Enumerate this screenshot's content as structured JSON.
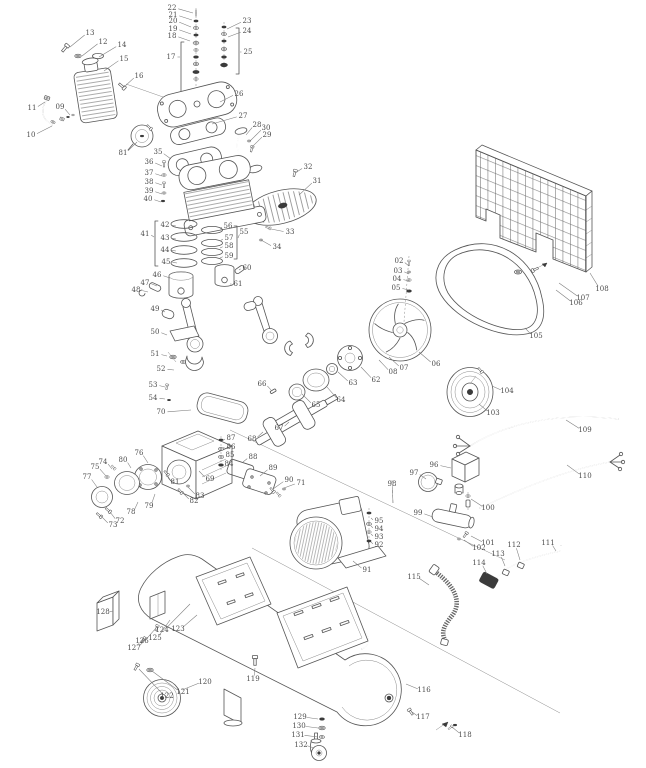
{
  "meta": {
    "description": "Exploded parts diagram of a belt-drive air compressor",
    "background": "#ffffff",
    "line_color": "#555555",
    "label_color": "#4c4c4c"
  },
  "labels": [
    {
      "n": "02",
      "x": 399,
      "y": 261,
      "lx": 409,
      "ly": 266
    },
    {
      "n": "03",
      "x": 398,
      "y": 271,
      "lx": 409,
      "ly": 274
    },
    {
      "n": "04",
      "x": 397,
      "y": 279,
      "lx": 409,
      "ly": 281
    },
    {
      "n": "05",
      "x": 396,
      "y": 288,
      "lx": 409,
      "ly": 290
    },
    {
      "n": "06",
      "x": 436,
      "y": 364,
      "lx": 419,
      "ly": 352
    },
    {
      "n": "07",
      "x": 404,
      "y": 368,
      "lx": 389,
      "ly": 357
    },
    {
      "n": "08",
      "x": 393,
      "y": 372,
      "lx": 379,
      "ly": 360
    },
    {
      "n": "09",
      "x": 60,
      "y": 107,
      "lx": 70,
      "ly": 115
    },
    {
      "n": "10",
      "x": 31,
      "y": 135,
      "lx": 52,
      "ly": 126
    },
    {
      "n": "11",
      "x": 32,
      "y": 108,
      "lx": 45,
      "ly": 102
    },
    {
      "n": "12",
      "x": 103,
      "y": 42,
      "lx": 82,
      "ly": 56
    },
    {
      "n": "13",
      "x": 90,
      "y": 33,
      "lx": 70,
      "ly": 47
    },
    {
      "n": "14",
      "x": 122,
      "y": 45,
      "lx": 99,
      "ly": 57
    },
    {
      "n": "15",
      "x": 124,
      "y": 59,
      "lx": 104,
      "ly": 71
    },
    {
      "n": "16",
      "x": 139,
      "y": 76,
      "lx": 124,
      "ly": 87
    },
    {
      "n": "17",
      "x": 171,
      "y": 57,
      "lx": 180,
      "ly": 57
    },
    {
      "n": "18",
      "x": 172,
      "y": 36,
      "lx": 190,
      "ly": 41
    },
    {
      "n": "19",
      "x": 173,
      "y": 29,
      "lx": 191,
      "ly": 34
    },
    {
      "n": "20",
      "x": 173,
      "y": 21,
      "lx": 191,
      "ly": 27
    },
    {
      "n": "21",
      "x": 173,
      "y": 15,
      "lx": 192,
      "ly": 20
    },
    {
      "n": "22",
      "x": 172,
      "y": 8,
      "lx": 193,
      "ly": 13
    },
    {
      "n": "23",
      "x": 247,
      "y": 21,
      "lx": 227,
      "ly": 29
    },
    {
      "n": "24",
      "x": 247,
      "y": 31,
      "lx": 228,
      "ly": 37
    },
    {
      "n": "25",
      "x": 248,
      "y": 52,
      "lx": 240,
      "ly": 52
    },
    {
      "n": "26",
      "x": 239,
      "y": 94,
      "lx": 220,
      "ly": 102
    },
    {
      "n": "27",
      "x": 243,
      "y": 116,
      "lx": 212,
      "ly": 124
    },
    {
      "n": "28",
      "x": 257,
      "y": 125,
      "lx": 246,
      "ly": 135
    },
    {
      "n": "29",
      "x": 267,
      "y": 135,
      "lx": 252,
      "ly": 147
    },
    {
      "n": "30",
      "x": 266,
      "y": 128,
      "lx": 250,
      "ly": 141
    },
    {
      "n": "31",
      "x": 317,
      "y": 181,
      "lx": 299,
      "ly": 195
    },
    {
      "n": "32",
      "x": 308,
      "y": 167,
      "lx": 295,
      "ly": 173
    },
    {
      "n": "33",
      "x": 290,
      "y": 232,
      "lx": 271,
      "ly": 229
    },
    {
      "n": "34",
      "x": 277,
      "y": 247,
      "lx": 261,
      "ly": 240
    },
    {
      "n": "35",
      "x": 158,
      "y": 152,
      "lx": 171,
      "ly": 159
    },
    {
      "n": "36",
      "x": 149,
      "y": 162,
      "lx": 162,
      "ly": 166
    },
    {
      "n": "37",
      "x": 149,
      "y": 173,
      "lx": 162,
      "ly": 176
    },
    {
      "n": "38",
      "x": 149,
      "y": 182,
      "lx": 162,
      "ly": 185
    },
    {
      "n": "39",
      "x": 149,
      "y": 191,
      "lx": 162,
      "ly": 194
    },
    {
      "n": "40",
      "x": 148,
      "y": 199,
      "lx": 161,
      "ly": 202
    },
    {
      "n": "41",
      "x": 145,
      "y": 234,
      "lx": 154,
      "ly": 237
    },
    {
      "n": "42",
      "x": 165,
      "y": 225,
      "lx": 176,
      "ly": 226
    },
    {
      "n": "43",
      "x": 165,
      "y": 238,
      "lx": 176,
      "ly": 239
    },
    {
      "n": "44",
      "x": 165,
      "y": 250,
      "lx": 176,
      "ly": 251
    },
    {
      "n": "45",
      "x": 166,
      "y": 262,
      "lx": 177,
      "ly": 263
    },
    {
      "n": "46",
      "x": 157,
      "y": 275,
      "lx": 170,
      "ly": 278
    },
    {
      "n": "47",
      "x": 145,
      "y": 283,
      "lx": 157,
      "ly": 286
    },
    {
      "n": "48",
      "x": 136,
      "y": 290,
      "lx": 148,
      "ly": 292
    },
    {
      "n": "49",
      "x": 155,
      "y": 309,
      "lx": 165,
      "ly": 312
    },
    {
      "n": "50",
      "x": 155,
      "y": 332,
      "lx": 167,
      "ly": 335
    },
    {
      "n": "51",
      "x": 155,
      "y": 354,
      "lx": 167,
      "ly": 356
    },
    {
      "n": "52",
      "x": 161,
      "y": 369,
      "lx": 174,
      "ly": 370
    },
    {
      "n": "53",
      "x": 153,
      "y": 385,
      "lx": 165,
      "ly": 387
    },
    {
      "n": "54",
      "x": 153,
      "y": 398,
      "lx": 165,
      "ly": 399
    },
    {
      "n": "55",
      "x": 244,
      "y": 232,
      "lx": 238,
      "ly": 238
    },
    {
      "n": "56",
      "x": 228,
      "y": 226,
      "lx": 220,
      "ly": 229
    },
    {
      "n": "57",
      "x": 229,
      "y": 238,
      "lx": 220,
      "ly": 241
    },
    {
      "n": "58",
      "x": 229,
      "y": 246,
      "lx": 220,
      "ly": 248
    },
    {
      "n": "59",
      "x": 229,
      "y": 256,
      "lx": 220,
      "ly": 258
    },
    {
      "n": "60",
      "x": 247,
      "y": 268,
      "lx": 239,
      "ly": 270
    },
    {
      "n": "61",
      "x": 238,
      "y": 284,
      "lx": 230,
      "ly": 284
    },
    {
      "n": "62",
      "x": 376,
      "y": 380,
      "lx": 361,
      "ly": 367
    },
    {
      "n": "63",
      "x": 353,
      "y": 383,
      "lx": 338,
      "ly": 372
    },
    {
      "n": "64",
      "x": 341,
      "y": 400,
      "lx": 327,
      "ly": 387
    },
    {
      "n": "65",
      "x": 316,
      "y": 405,
      "lx": 302,
      "ly": 394
    },
    {
      "n": "66",
      "x": 262,
      "y": 384,
      "lx": 271,
      "ly": 390
    },
    {
      "n": "67",
      "x": 279,
      "y": 428,
      "lx": 289,
      "ly": 422
    },
    {
      "n": "68",
      "x": 252,
      "y": 439,
      "lx": 263,
      "ly": 432
    },
    {
      "n": "69",
      "x": 210,
      "y": 479,
      "lx": 199,
      "ly": 471
    },
    {
      "n": "70",
      "x": 161,
      "y": 412,
      "lx": 191,
      "ly": 410
    },
    {
      "n": "71",
      "x": 301,
      "y": 483,
      "lx": 284,
      "ly": 488
    },
    {
      "n": "72",
      "x": 120,
      "y": 521,
      "lx": 110,
      "ly": 512
    },
    {
      "n": "73",
      "x": 113,
      "y": 525,
      "lx": 101,
      "ly": 516
    },
    {
      "n": "74",
      "x": 103,
      "y": 462,
      "lx": 112,
      "ly": 469
    },
    {
      "n": "75",
      "x": 95,
      "y": 467,
      "lx": 106,
      "ly": 476
    },
    {
      "n": "76",
      "x": 139,
      "y": 453,
      "lx": 148,
      "ly": 463
    },
    {
      "n": "77",
      "x": 87,
      "y": 477,
      "lx": 97,
      "ly": 487
    },
    {
      "n": "78",
      "x": 131,
      "y": 512,
      "lx": 138,
      "ly": 502
    },
    {
      "n": "79",
      "x": 149,
      "y": 506,
      "lx": 155,
      "ly": 494
    },
    {
      "n": "80",
      "x": 123,
      "y": 460,
      "lx": 131,
      "ly": 468
    },
    {
      "n": "81",
      "x": 175,
      "y": 482,
      "lx": 167,
      "ly": 475
    },
    {
      "n": "81",
      "x": 123,
      "y": 153,
      "lx": 137,
      "ly": 142
    },
    {
      "n": "82",
      "x": 194,
      "y": 501,
      "lx": 182,
      "ly": 492
    },
    {
      "n": "83",
      "x": 200,
      "y": 496,
      "lx": 188,
      "ly": 487
    },
    {
      "n": "84",
      "x": 229,
      "y": 464,
      "lx": 222,
      "ly": 464
    },
    {
      "n": "85",
      "x": 230,
      "y": 455,
      "lx": 222,
      "ly": 456
    },
    {
      "n": "86",
      "x": 231,
      "y": 447,
      "lx": 222,
      "ly": 448
    },
    {
      "n": "87",
      "x": 231,
      "y": 438,
      "lx": 222,
      "ly": 441
    },
    {
      "n": "88",
      "x": 253,
      "y": 457,
      "lx": 243,
      "ly": 462
    },
    {
      "n": "89",
      "x": 273,
      "y": 468,
      "lx": 260,
      "ly": 476
    },
    {
      "n": "90",
      "x": 289,
      "y": 480,
      "lx": 273,
      "ly": 489
    },
    {
      "n": "91",
      "x": 367,
      "y": 570,
      "lx": 353,
      "ly": 561
    },
    {
      "n": "92",
      "x": 379,
      "y": 545,
      "lx": 371,
      "ly": 542
    },
    {
      "n": "93",
      "x": 379,
      "y": 537,
      "lx": 371,
      "ly": 534
    },
    {
      "n": "94",
      "x": 379,
      "y": 529,
      "lx": 371,
      "ly": 526
    },
    {
      "n": "95",
      "x": 379,
      "y": 521,
      "lx": 371,
      "ly": 518
    },
    {
      "n": "96",
      "x": 434,
      "y": 465,
      "lx": 451,
      "ly": 468
    },
    {
      "n": "97",
      "x": 414,
      "y": 473,
      "lx": 426,
      "ly": 479
    },
    {
      "n": "98",
      "x": 392,
      "y": 484,
      "lx": 393,
      "ly": 503
    },
    {
      "n": "99",
      "x": 418,
      "y": 513,
      "lx": 433,
      "ly": 517
    },
    {
      "n": "100",
      "x": 488,
      "y": 508,
      "lx": 471,
      "ly": 499
    },
    {
      "n": "101",
      "x": 488,
      "y": 543,
      "lx": 471,
      "ly": 536
    },
    {
      "n": "102",
      "x": 479,
      "y": 548,
      "lx": 464,
      "ly": 540
    },
    {
      "n": "103",
      "x": 493,
      "y": 413,
      "lx": 479,
      "ly": 404
    },
    {
      "n": "104",
      "x": 507,
      "y": 391,
      "lx": 492,
      "ly": 386
    },
    {
      "n": "105",
      "x": 536,
      "y": 336,
      "lx": 525,
      "ly": 328
    },
    {
      "n": "106",
      "x": 576,
      "y": 303,
      "lx": 556,
      "ly": 290
    },
    {
      "n": "107",
      "x": 583,
      "y": 298,
      "lx": 559,
      "ly": 283
    },
    {
      "n": "108",
      "x": 602,
      "y": 289,
      "lx": 590,
      "ly": 273
    },
    {
      "n": "109",
      "x": 585,
      "y": 430,
      "lx": 566,
      "ly": 420
    },
    {
      "n": "110",
      "x": 585,
      "y": 476,
      "lx": 567,
      "ly": 465
    },
    {
      "n": "111",
      "x": 548,
      "y": 543,
      "lx": 556,
      "ly": 551
    },
    {
      "n": "112",
      "x": 514,
      "y": 545,
      "lx": 520,
      "ly": 560
    },
    {
      "n": "113",
      "x": 498,
      "y": 554,
      "lx": 505,
      "ly": 566
    },
    {
      "n": "114",
      "x": 479,
      "y": 563,
      "lx": 487,
      "ly": 574
    },
    {
      "n": "115",
      "x": 414,
      "y": 577,
      "lx": 429,
      "ly": 585
    },
    {
      "n": "116",
      "x": 424,
      "y": 690,
      "lx": 406,
      "ly": 684
    },
    {
      "n": "117",
      "x": 423,
      "y": 717,
      "lx": 412,
      "ly": 712
    },
    {
      "n": "118",
      "x": 465,
      "y": 735,
      "lx": 452,
      "ly": 727
    },
    {
      "n": "119",
      "x": 253,
      "y": 679,
      "lx": 255,
      "ly": 668
    },
    {
      "n": "120",
      "x": 205,
      "y": 682,
      "lx": 182,
      "ly": 690
    },
    {
      "n": "121",
      "x": 183,
      "y": 692,
      "lx": 152,
      "ly": 671
    },
    {
      "n": "122",
      "x": 167,
      "y": 696,
      "lx": 139,
      "ly": 669
    },
    {
      "n": "123",
      "x": 178,
      "y": 629,
      "lx": 197,
      "ly": 615
    },
    {
      "n": "124",
      "x": 162,
      "y": 630,
      "lx": 190,
      "ly": 604
    },
    {
      "n": "125",
      "x": 155,
      "y": 638,
      "lx": 170,
      "ly": 620
    },
    {
      "n": "126",
      "x": 142,
      "y": 641,
      "lx": 156,
      "ly": 628
    },
    {
      "n": "127",
      "x": 134,
      "y": 648,
      "lx": 145,
      "ly": 640
    },
    {
      "n": "128",
      "x": 103,
      "y": 612,
      "lx": 113,
      "ly": 611
    },
    {
      "n": "129",
      "x": 300,
      "y": 717,
      "lx": 318,
      "ly": 719
    },
    {
      "n": "130",
      "x": 299,
      "y": 726,
      "lx": 318,
      "ly": 728
    },
    {
      "n": "131",
      "x": 298,
      "y": 735,
      "lx": 318,
      "ly": 737
    },
    {
      "n": "132",
      "x": 301,
      "y": 745,
      "lx": 314,
      "ly": 748
    }
  ]
}
